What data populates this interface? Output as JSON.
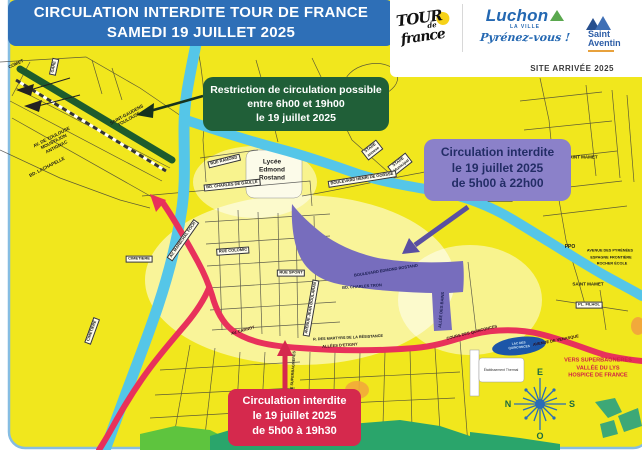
{
  "banner": {
    "line1": "CIRCULATION INTERDITE  TOUR DE FRANCE",
    "line2": "SAMEDI 19 JUILLET 2025"
  },
  "logos": {
    "tdf": {
      "tour": "TOUR",
      "de": "de",
      "france": "france"
    },
    "luchon": {
      "name": "Luchon",
      "subtitle": "LA VILLE",
      "tagline": "Pyrénez-vous !"
    },
    "saint_aventin": {
      "line1": "Saint",
      "line2": "Aventin"
    },
    "site_arrivee": "SITE ARRIVÉE 2025"
  },
  "callouts": {
    "green": {
      "line1": "Restriction de circulation possible",
      "line2": "entre 6h00 et 19h00",
      "line3": "le 19 juillet 2025"
    },
    "purple": {
      "line1": "Circulation interdite",
      "line2": "le 19 juillet 2025",
      "line3": "de 5h00 à 22h00"
    },
    "red": {
      "line1": "Circulation interdite",
      "line2": "le 19 juillet 2025",
      "line3": "de 5h00 à 19h30"
    }
  },
  "colors": {
    "banner_blue": "#2e6fb7",
    "map_yellow": "#f1e71d",
    "river_blue": "#55c6e8",
    "zone_purple": "#776dbd",
    "route_red": "#e8315b",
    "restricted_green": "#1e5c2d",
    "callout_red": "#d5294d",
    "callout_purple": "#8b81c9",
    "callout_green": "#205f38"
  },
  "map": {
    "compass": {
      "e": "E",
      "s": "S",
      "o": "O",
      "n": "N"
    },
    "labels": [
      {
        "t": "COMET",
        "x": 16,
        "y": 64,
        "r": -25,
        "s": "plain"
      },
      {
        "t": "GARE",
        "x": 54,
        "y": 67,
        "r": -78,
        "s": "box"
      },
      {
        "t": "SAINT-GAUDENS\nTOULOUSE",
        "x": 128,
        "y": 117,
        "r": -29,
        "s": "plain"
      },
      {
        "t": "AV. DE TOULOUSE\nMOUSTAJON\nANTIGNAC",
        "x": 54,
        "y": 142,
        "r": -27,
        "s": "plain"
      },
      {
        "t": "BD. LACHAPELLE",
        "x": 47,
        "y": 167,
        "r": -27,
        "s": "plain"
      },
      {
        "t": "RUE RAMOND",
        "x": 224,
        "y": 161,
        "r": -14,
        "s": "box"
      },
      {
        "t": "BD. CHARLES DE GAULLE",
        "x": 232,
        "y": 185,
        "r": -6,
        "s": "box"
      },
      {
        "t": "Lycée\nEdmond\nRostand",
        "x": 272,
        "y": 170,
        "r": 0,
        "s": "big"
      },
      {
        "t": "STADE\nannexe",
        "x": 372,
        "y": 150,
        "r": -38,
        "s": "box"
      },
      {
        "t": "STADE\nMunicipal",
        "x": 400,
        "y": 164,
        "r": -38,
        "s": "box"
      },
      {
        "t": "BOULEVARD HENRI DE GORSSE",
        "x": 362,
        "y": 179,
        "r": -9,
        "s": "box"
      },
      {
        "t": "SAINT MAMET",
        "x": 582,
        "y": 157,
        "r": 0,
        "s": "plain"
      },
      {
        "t": "FRONTON",
        "x": 500,
        "y": 198,
        "r": 0,
        "s": "box"
      },
      {
        "t": "SAINT MAMET",
        "x": 588,
        "y": 284,
        "r": 0,
        "s": "plain"
      },
      {
        "t": "PPO",
        "x": 570,
        "y": 247,
        "r": 0,
        "s": "ppo"
      },
      {
        "t": "AVENUE DES PYRÉNÉES",
        "x": 610,
        "y": 251,
        "r": 0,
        "s": "tiny"
      },
      {
        "t": "ESPAGNE FRONTIÈRE",
        "x": 611,
        "y": 258,
        "r": 0,
        "s": "tiny"
      },
      {
        "t": "ROCHER ÉCOLE",
        "x": 612,
        "y": 264,
        "r": 0,
        "s": "tiny"
      },
      {
        "t": "BOULEVARD EDMOND ROSTAND",
        "x": 386,
        "y": 271,
        "r": -9,
        "s": "onpurple"
      },
      {
        "t": "BD. CHARLES TRON",
        "x": 362,
        "y": 287,
        "r": -4,
        "s": "onpurple"
      },
      {
        "t": "ALLÉE DES BAINS",
        "x": 442,
        "y": 310,
        "r": -85,
        "s": "onpurple"
      },
      {
        "t": "AVENUE JEAN BOULARAN",
        "x": 311,
        "y": 308,
        "r": -80,
        "s": "box"
      },
      {
        "t": "R. DES MARTYRS DE LA RÉSISTANCE",
        "x": 348,
        "y": 338,
        "r": -3,
        "s": "tiny"
      },
      {
        "t": "AV. CARNOT",
        "x": 243,
        "y": 331,
        "r": -16,
        "s": "onred"
      },
      {
        "t": "ALLÉES D'ETIGNY",
        "x": 340,
        "y": 346,
        "r": -4,
        "s": "onred"
      },
      {
        "t": "COURS DES QUINCONCES",
        "x": 472,
        "y": 333,
        "r": -14,
        "s": "onred"
      },
      {
        "t": "AVENUE DE VENASQUE",
        "x": 556,
        "y": 341,
        "r": -11,
        "s": "onred"
      },
      {
        "t": "AV. MARÉCHAL FOCH",
        "x": 183,
        "y": 240,
        "r": -55,
        "s": "box"
      },
      {
        "t": "CIMETIERE",
        "x": 139,
        "y": 259,
        "r": 0,
        "s": "box"
      },
      {
        "t": "CIMETIERE",
        "x": 92,
        "y": 331,
        "r": -70,
        "s": "box"
      },
      {
        "t": "RUE COLOMIC",
        "x": 233,
        "y": 251,
        "r": -4,
        "s": "box"
      },
      {
        "t": "RUE SPONT",
        "x": 291,
        "y": 273,
        "r": 0,
        "s": "box"
      },
      {
        "t": "PL. FILHOL",
        "x": 589,
        "y": 305,
        "r": 0,
        "s": "box"
      },
      {
        "t": "RUE DE SUPERBAGNERES",
        "x": 293,
        "y": 376,
        "r": -86,
        "s": "tiny"
      },
      {
        "t": "Établissement Thermal",
        "x": 501,
        "y": 370,
        "r": 0,
        "s": "white"
      },
      {
        "t": "LAC DES\nQUINCONCES",
        "x": 519,
        "y": 346,
        "r": -6,
        "s": "lake"
      },
      {
        "t": "VERS SUPERBAGNERES\nVALLÉE DU LYS\nHOSPICE DE FRANCE",
        "x": 598,
        "y": 369,
        "r": 0,
        "s": "dest"
      }
    ]
  }
}
